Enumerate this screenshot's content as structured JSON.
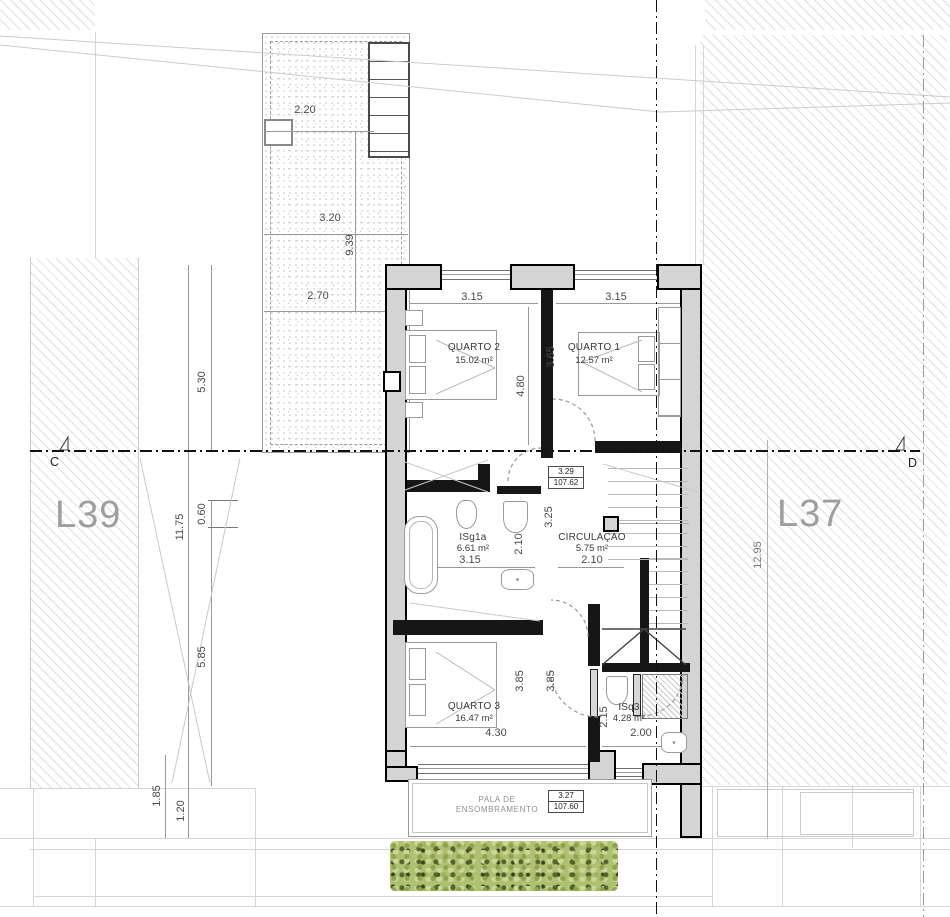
{
  "drawing": {
    "lots": {
      "left": "L39",
      "right": "L37"
    },
    "section_markers": {
      "left": "C",
      "right": "D"
    },
    "rooms": {
      "quarto2": {
        "name": "QUARTO 2",
        "area": "15.02 m²"
      },
      "quarto1": {
        "name": "QUARTO 1",
        "area": "12.57 m²"
      },
      "isg1a": {
        "name": "ISg1a",
        "area": "6.61 m²"
      },
      "circulacao": {
        "name": "CIRCULAÇÃO",
        "area": "5.75 m²"
      },
      "quarto3": {
        "name": "QUARTO 3",
        "area": "16.47 m²"
      },
      "isq3": {
        "name": "ISq3",
        "area": "4.28 m²"
      }
    },
    "canopy": {
      "line1": "PALA DE",
      "line2": "ENSOMBRAMENTO"
    },
    "levels": {
      "upper": {
        "height": "3.29",
        "elevation": "107.62"
      },
      "lower": {
        "height": "3.27",
        "elevation": "107.60"
      }
    },
    "dims": {
      "patio_w_top": "2.20",
      "patio_w_mid": "3.20",
      "patio_len": "9.39",
      "patio_w_bot": "2.70",
      "left_530": "5.30",
      "left_1175": "11.75",
      "left_060": "0.60",
      "left_585": "5.85",
      "left_185": "1.85",
      "left_120": "1.20",
      "right_1295": "12.95",
      "q2_w": "3.15",
      "q1_w": "3.15",
      "q2_h": "4.80",
      "q1_h": "3.65",
      "hall_325": "3.25",
      "bath_w": "3.15",
      "bath_h": "2.10",
      "circ_w": "2.10",
      "q3_h": "3.85",
      "circ_h": "3.85",
      "q3_w": "4.30",
      "isq3_h": "2.15",
      "isq3_w": "2.00"
    },
    "colors": {
      "wall_fill": "#d4d4d4",
      "wall_line": "#000000",
      "label_gray": "#9e9e9e",
      "dim_gray": "#4a4a4a",
      "hedge_green": "#aec173"
    }
  }
}
